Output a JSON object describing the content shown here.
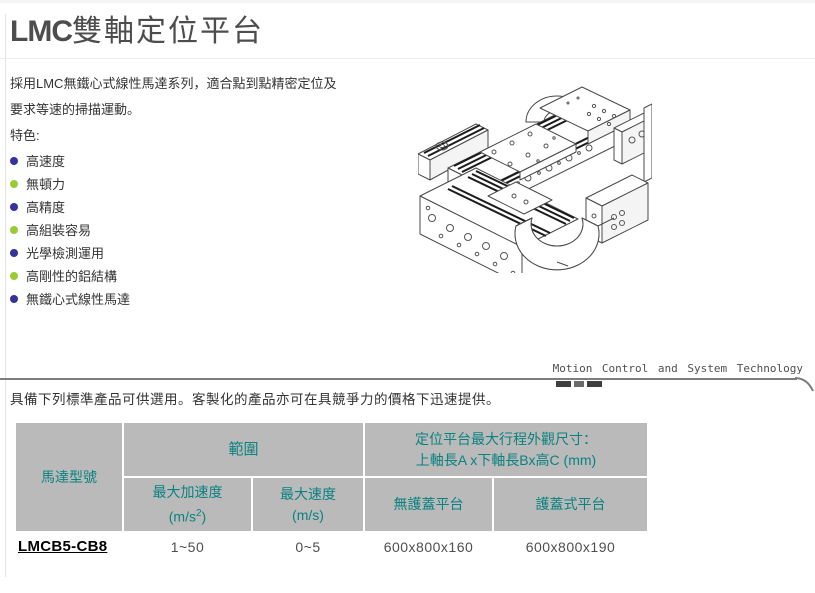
{
  "title": {
    "brand": "LMC",
    "rest": "雙軸定位平台"
  },
  "intro": {
    "line1": "採用LMC無鐵心式線性馬達系列，適合點到點精密定位及",
    "line2": "要求等速的掃描運動。",
    "features_label": "特色:"
  },
  "features": {
    "items": [
      {
        "label": "高速度",
        "bullet_color": "#333399"
      },
      {
        "label": "無頓力",
        "bullet_color": "#99cc33"
      },
      {
        "label": "高精度",
        "bullet_color": "#333399"
      },
      {
        "label": "高組裝容易",
        "bullet_color": "#99cc33"
      },
      {
        "label": "光學檢測運用",
        "bullet_color": "#333399"
      },
      {
        "label": "高剛性的鋁結構",
        "bullet_color": "#99cc33"
      },
      {
        "label": "無鐵心式線性馬達",
        "bullet_color": "#333399"
      }
    ]
  },
  "figure": {
    "name": "dual-axis-positioning-stage-isometric-drawing"
  },
  "banner": {
    "text": "Motion Control and System Technology"
  },
  "products": {
    "intro": "具備下列標準產品可供選用。客製化的產品亦可在具競爭力的價格下迅速提供。",
    "table": {
      "headers": {
        "motor_model": "馬達型號",
        "range": "範圍",
        "max_accel_label": "最大加速度",
        "max_accel_unit_prefix": "(m/s",
        "max_accel_unit_sup": "2",
        "max_accel_unit_suffix": ")",
        "max_speed_label": "最大速度",
        "max_speed_unit": "(m/s)",
        "dims_line1": "定位平台最大行程外觀尺寸：",
        "dims_line2": "上軸長A x下軸長Bx高C (mm)",
        "no_cover": "無護蓋平台",
        "covered": "護蓋式平台"
      },
      "rows": [
        {
          "model": "LMCB5-CB8",
          "max_accel": "1~50",
          "max_speed": "0~5",
          "no_cover_dims": "600x800x160",
          "covered_dims": "600x800x190"
        }
      ]
    }
  },
  "colors": {
    "header_bg": "#bababa",
    "header_text": "#0a8280",
    "bullet_navy": "#333399",
    "bullet_green": "#99cc33",
    "banner_line": "#7d7d7d",
    "dash_dark": "#3f3f3f",
    "dash_mid": "#6a6a6a"
  }
}
